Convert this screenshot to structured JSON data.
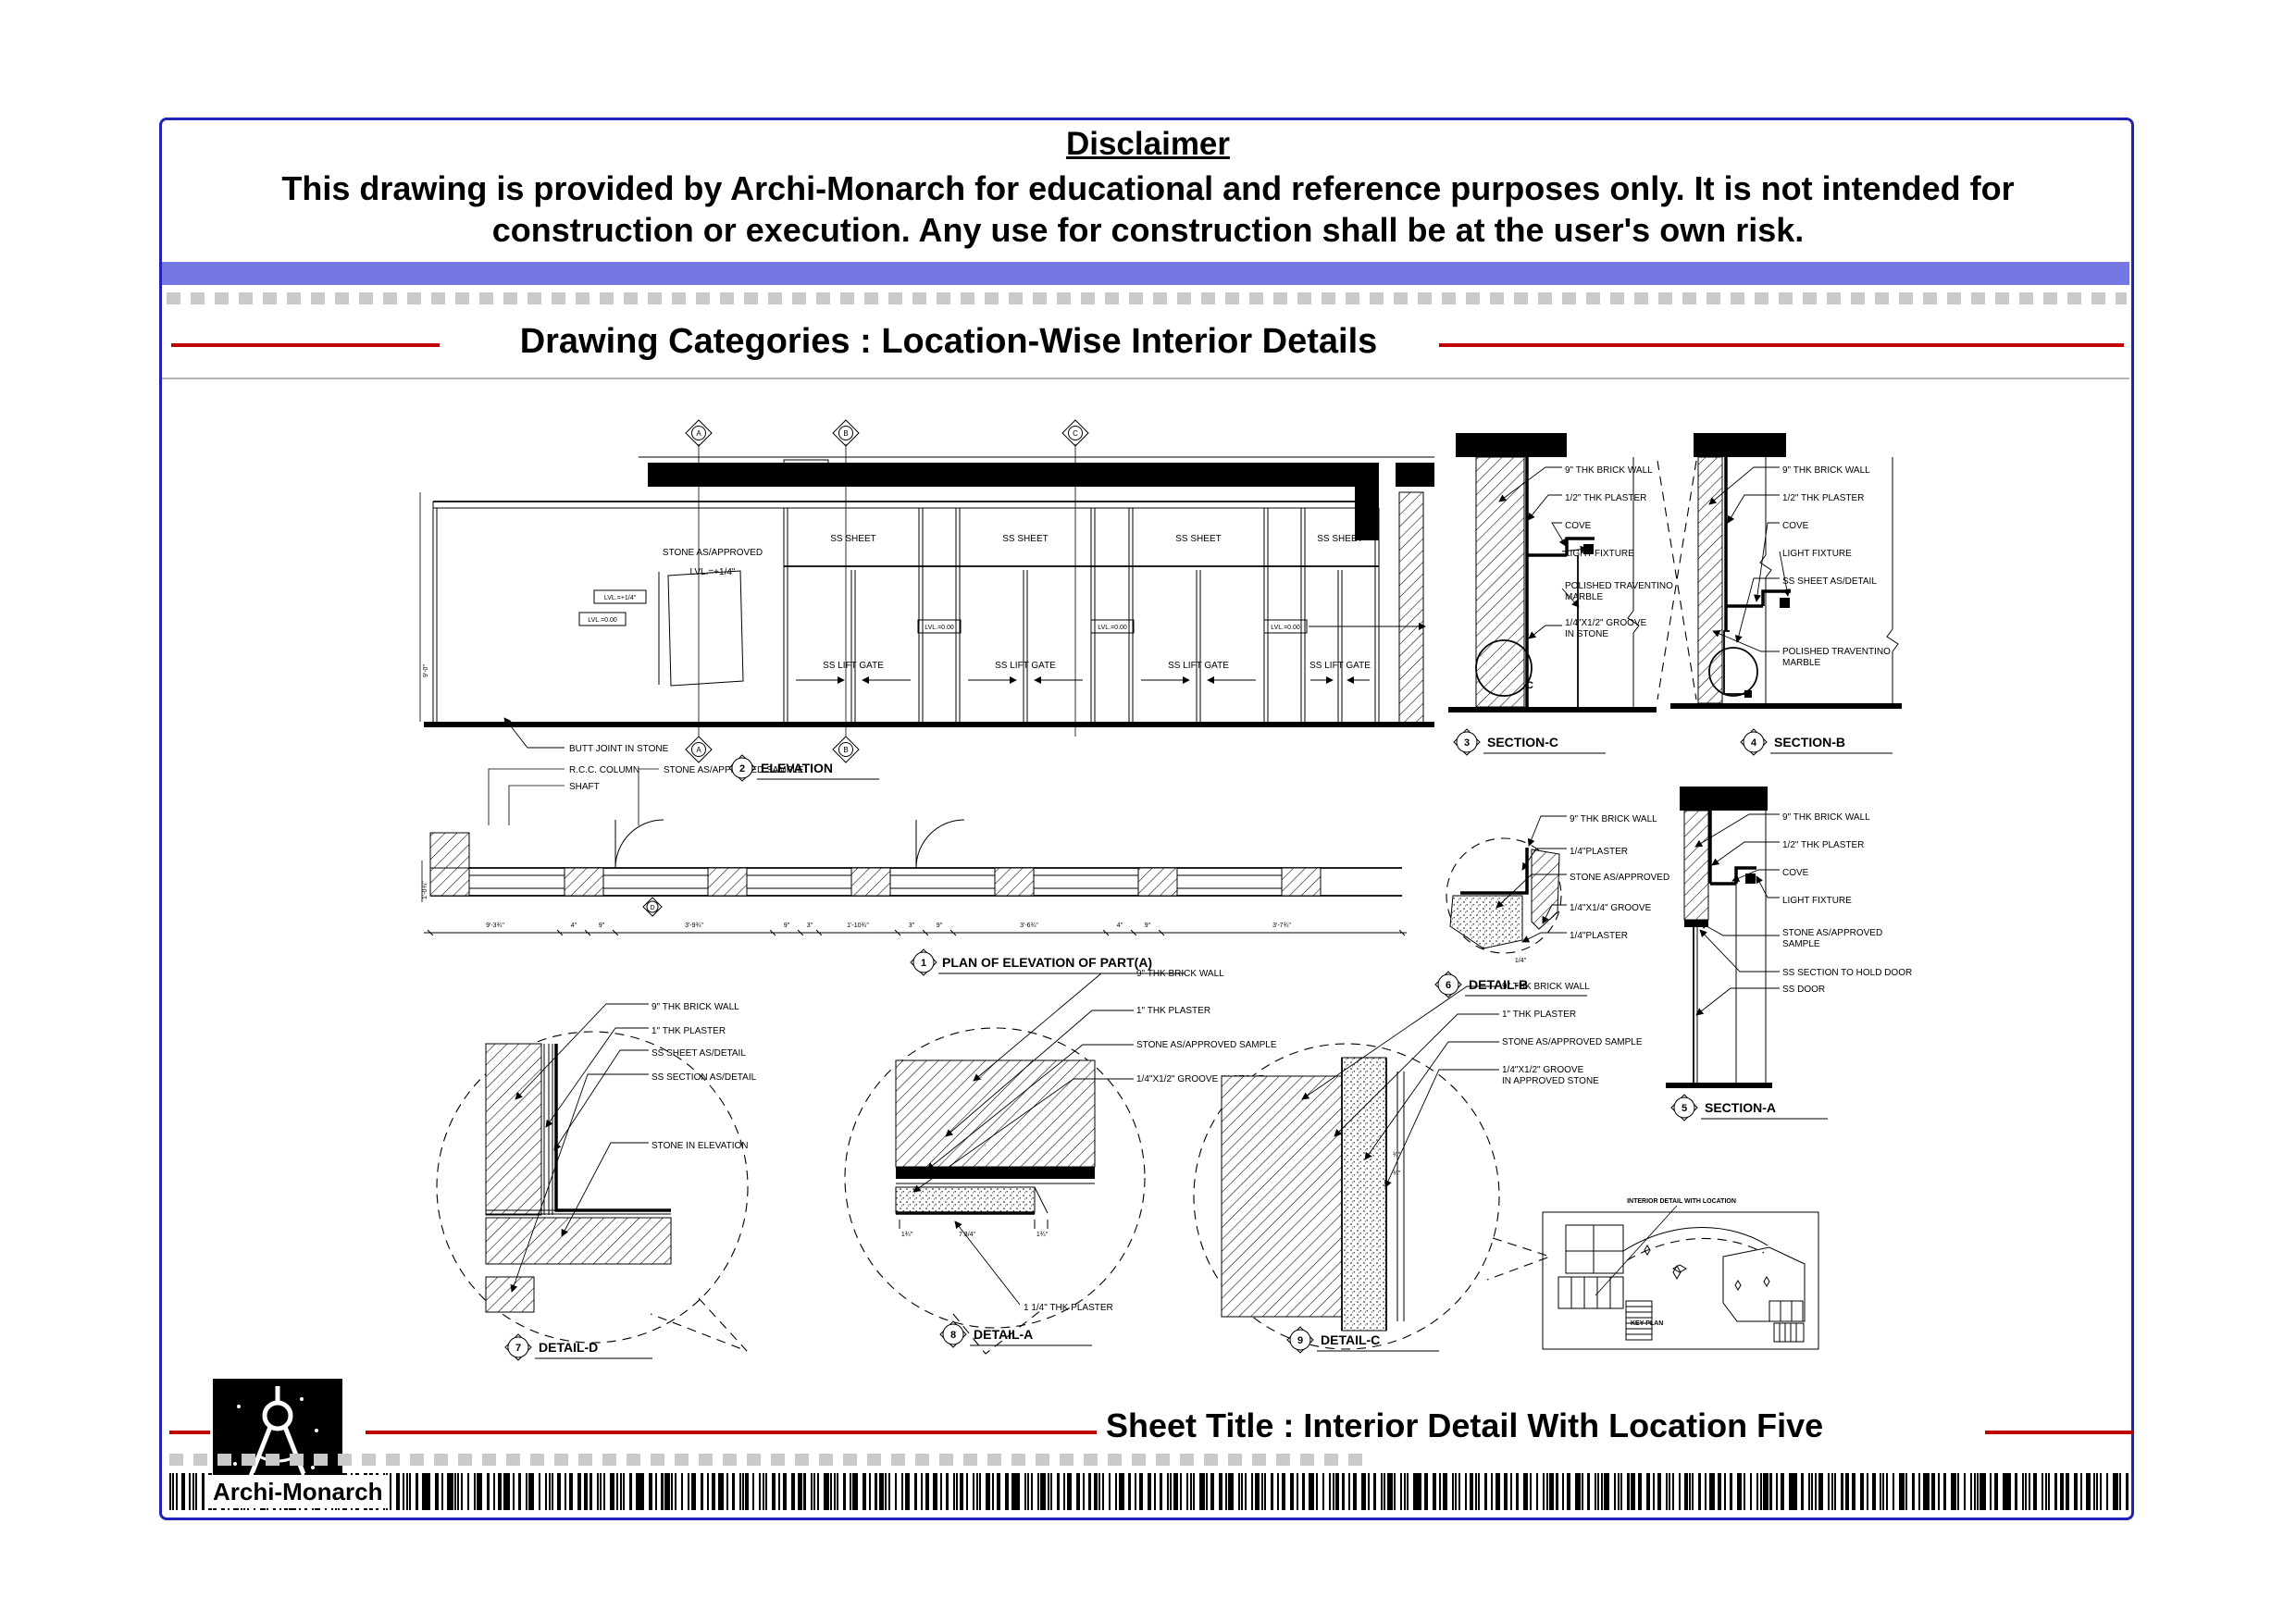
{
  "header": {
    "disclaimer_title": "Disclaimer",
    "disclaimer_line1": "This drawing is provided by Archi-Monarch for educational and reference purposes only. It is not intended for",
    "disclaimer_line2": "construction or execution. Any use for construction shall be at the user's own risk.",
    "category_title": "Drawing Categories : Location-Wise Interior Details"
  },
  "footer": {
    "sheet_title": "Sheet Title : Interior Detail With Location Five",
    "brand": "Archi-Monarch"
  },
  "colors": {
    "border_blue": "#2222bb",
    "bar_purple": "#7577e2",
    "line_red": "#c00000"
  },
  "elevation": {
    "num": "2",
    "title": "ELEVATION",
    "grids": [
      "A",
      "B",
      "C"
    ],
    "stone_approved": "STONE AS/APPROVED",
    "lvl_plus": "LVL.=+1/4\"",
    "lvl_zero": "LVL.=0.00",
    "ss_sheet": "SS SHEET",
    "ss_lift_gate": "SS LIFT GATE",
    "dim_height": "9'-0\"",
    "callout_butt": "BUTT JOINT IN STONE",
    "callout_rcc": "R.C.C. COLUMN",
    "callout_shaft": "SHAFT",
    "callout_stone_sample": "STONE AS/APPROVED SAMPLE"
  },
  "plan": {
    "num": "1",
    "title": "PLAN OF ELEVATION OF PART(A)",
    "marker": "D",
    "dim_left": "1'-0¾\"",
    "dims": [
      "9'-3¾\"",
      "4\"",
      "9\"",
      "3'-9¾\"",
      "9\"",
      "3\"",
      "1'-10¾\"",
      "3\"",
      "9\"",
      "3'-6¾\"",
      "4\"",
      "9\"",
      "3'-7¾\""
    ]
  },
  "section_c": {
    "num": "3",
    "title": "SECTION-C",
    "marker": "C",
    "labels": [
      "9\" THK BRICK WALL",
      "1/2\" THK PLASTER",
      "COVE",
      "LIGHT FIXTURE",
      "POLISHED TRAVENTINO",
      "MARBLE",
      "1/4\"X1/2\" GROOVE",
      "IN STONE"
    ]
  },
  "section_b": {
    "num": "4",
    "title": "SECTION-B",
    "labels": [
      "9\" THK BRICK WALL",
      "1/2\" THK PLASTER",
      "COVE",
      "LIGHT FIXTURE",
      "SS SHEET AS/DETAIL",
      "POLISHED TRAVENTINO",
      "MARBLE"
    ]
  },
  "section_a": {
    "num": "5",
    "title": "SECTION-A",
    "labels": [
      "9\" THK BRICK WALL",
      "1/2\" THK PLASTER",
      "COVE",
      "LIGHT FIXTURE",
      "STONE AS/APPROVED",
      "SAMPLE",
      "SS SECTION TO HOLD DOOR",
      "SS DOOR"
    ]
  },
  "detail_b": {
    "num": "6",
    "title": "DETAIL-B",
    "dim": "1/4\"",
    "labels": [
      "9\" THK BRICK WALL",
      "1/4\"PLASTER",
      "STONE AS/APPROVED",
      "1/4\"X1/4\" GROOVE",
      "1/4\"PLASTER"
    ]
  },
  "detail_d": {
    "num": "7",
    "title": "DETAIL-D",
    "labels": [
      "9\" THK BRICK WALL",
      "1\" THK PLASTER",
      "SS SHEET AS/DETAIL",
      "SS SECTION AS/DETAIL",
      "STONE IN ELEVATION"
    ]
  },
  "detail_a": {
    "num": "8",
    "title": "DETAIL-A",
    "plaster_note": "1 1/4\" THK PLASTER",
    "dims": [
      "1¾\"",
      "7 3/4\"",
      "1¾\""
    ],
    "labels": [
      "9\" THK BRICK WALL",
      "1\" THK PLASTER",
      "STONE AS/APPROVED SAMPLE",
      "1/4\"X1/2\" GROOVE IN STONE"
    ]
  },
  "detail_c": {
    "num": "9",
    "title": "DETAIL-C",
    "dims": [
      "¾\"",
      "¾\""
    ],
    "labels": [
      "9\" THK BRICK WALL",
      "1\" THK PLASTER",
      "STONE AS/APPROVED SAMPLE",
      "1/4\"X1/2\" GROOVE",
      "IN APPROVED STONE"
    ]
  },
  "key_plan": {
    "caption": "INTERIOR DETAIL WITH LOCATION",
    "label": "KEY PLAN"
  }
}
